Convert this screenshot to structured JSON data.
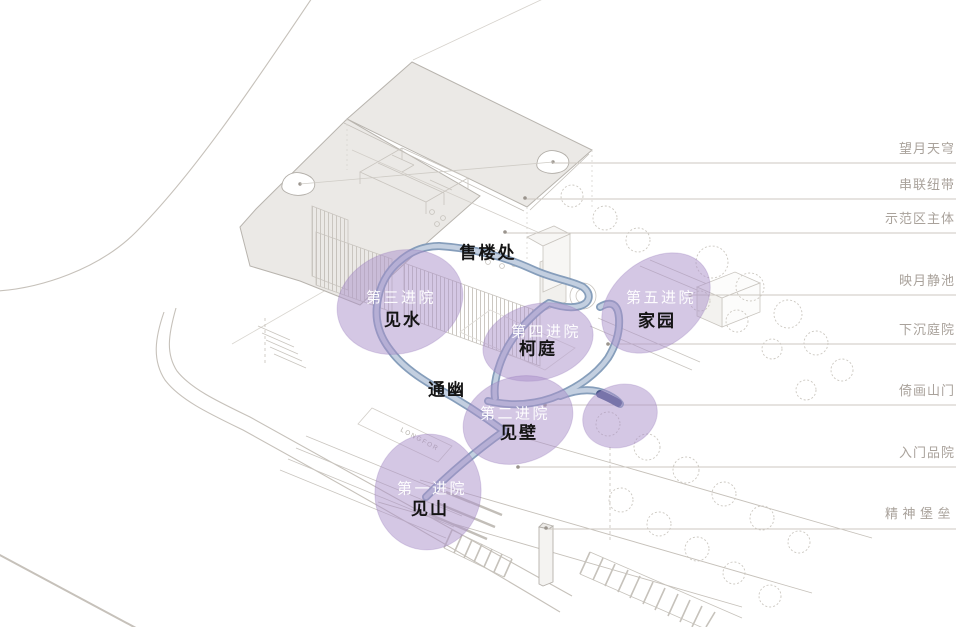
{
  "diagram": {
    "watermark": "LONGFOR",
    "sales_office_label": "售楼处",
    "corridor_label": "通幽"
  },
  "courtyards": [
    {
      "court": "第一进院",
      "name": "见山"
    },
    {
      "court": "第二进院",
      "name": "见壁"
    },
    {
      "court": "第三进院",
      "name": "见水"
    },
    {
      "court": "第四进院",
      "name": "柯庭"
    },
    {
      "court": "第五进院",
      "name": "家园"
    }
  ],
  "callouts": [
    "望月天穹",
    "串联纽带",
    "示范区主体",
    "映月静池",
    "下沉庭院",
    "倚画山门",
    "入门品院",
    "精神堡垒"
  ],
  "colors": {
    "highlight_purple": "#a98fc9",
    "ribbon_blue": "#8ba0bf",
    "ribbon_light": "#c3cfe0",
    "ribbon_tip": "#47588a",
    "callout_text": "#a9a29b",
    "sketch_line": "#c9c5bf"
  }
}
